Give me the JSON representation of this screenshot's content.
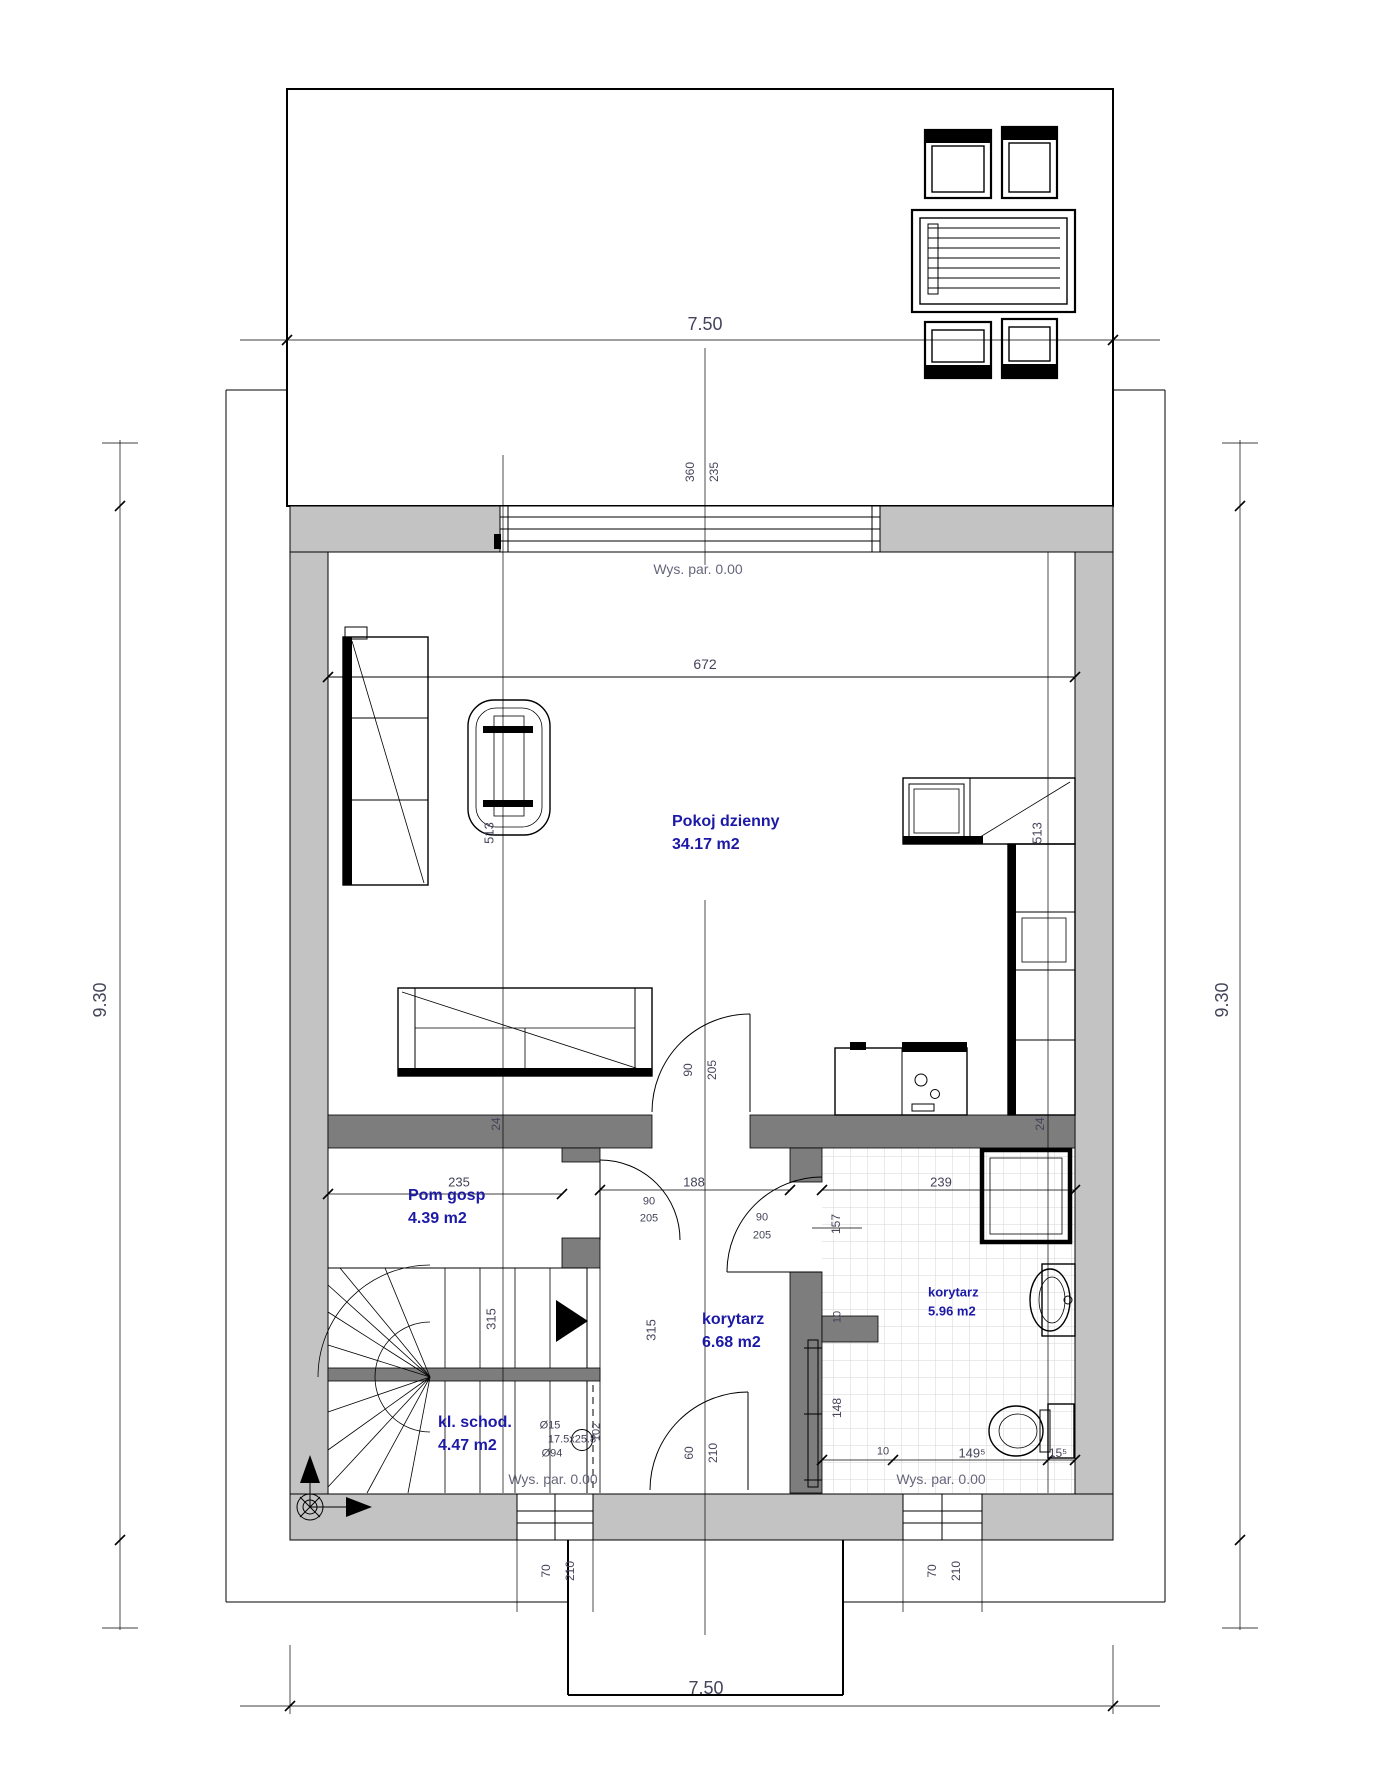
{
  "colors": {
    "outer_wall": "#c3c3c3",
    "partition_wall": "#7d7d7d",
    "room_label": "#1c19a6",
    "dim_text": "#44445a",
    "level_text": "#66667c",
    "line": "#000000",
    "tile_line": "#d6d6d6"
  },
  "rooms": [
    {
      "name": "Pokoj dzienny",
      "area": "34.17 m2",
      "x": 672,
      "y": 822,
      "small": false
    },
    {
      "name": "Pom gosp",
      "area": "4.39 m2",
      "x": 408,
      "y": 1196,
      "small": false
    },
    {
      "name": "korytarz",
      "area": "6.68 m2",
      "x": 702,
      "y": 1320,
      "small": false
    },
    {
      "name": "korytarz",
      "area": "5.96 m2",
      "x": 928,
      "y": 1292,
      "small": true
    },
    {
      "name": "kl. schod.",
      "area": "4.47 m2",
      "x": 438,
      "y": 1423,
      "small": false
    }
  ],
  "levels": [
    {
      "text": "Wys. par. 0.00",
      "x": 698,
      "y": 569
    },
    {
      "text": "Wys. par. 0.00",
      "x": 553,
      "y": 1479
    },
    {
      "text": "Wys. par. 0.00",
      "x": 941,
      "y": 1479
    }
  ],
  "dims": [
    {
      "t": "7.50",
      "x": 705,
      "y": 324,
      "rot": 0,
      "s": 18
    },
    {
      "t": "7.50",
      "x": 706,
      "y": 1688,
      "rot": 0,
      "s": 18
    },
    {
      "t": "9.30",
      "x": 100,
      "y": 1000,
      "rot": 1,
      "s": 18
    },
    {
      "t": "9.30",
      "x": 1222,
      "y": 1000,
      "rot": 1,
      "s": 18
    },
    {
      "t": "360",
      "x": 690,
      "y": 472,
      "rot": 1,
      "s": 12
    },
    {
      "t": "235",
      "x": 714,
      "y": 472,
      "rot": 1,
      "s": 12
    },
    {
      "t": "672",
      "x": 705,
      "y": 664,
      "rot": 0,
      "s": 14
    },
    {
      "t": "513",
      "x": 489,
      "y": 833,
      "rot": 1,
      "s": 13
    },
    {
      "t": "513",
      "x": 1037,
      "y": 833,
      "rot": 1,
      "s": 13
    },
    {
      "t": "24",
      "x": 496,
      "y": 1124,
      "rot": 1,
      "s": 12
    },
    {
      "t": "24",
      "x": 1040,
      "y": 1124,
      "rot": 1,
      "s": 12
    },
    {
      "t": "90",
      "x": 688,
      "y": 1070,
      "rot": 1,
      "s": 12
    },
    {
      "t": "205",
      "x": 712,
      "y": 1070,
      "rot": 1,
      "s": 12
    },
    {
      "t": "235",
      "x": 459,
      "y": 1182,
      "rot": 0,
      "s": 13
    },
    {
      "t": "188",
      "x": 694,
      "y": 1182,
      "rot": 0,
      "s": 13
    },
    {
      "t": "90",
      "x": 649,
      "y": 1202,
      "rot": 0,
      "s": 11
    },
    {
      "t": "205",
      "x": 649,
      "y": 1219,
      "rot": 0,
      "s": 11
    },
    {
      "t": "90",
      "x": 762,
      "y": 1218,
      "rot": 0,
      "s": 11
    },
    {
      "t": "205",
      "x": 762,
      "y": 1236,
      "rot": 0,
      "s": 11
    },
    {
      "t": "157",
      "x": 836,
      "y": 1224,
      "rot": 1,
      "s": 12
    },
    {
      "t": "239",
      "x": 941,
      "y": 1182,
      "rot": 0,
      "s": 13
    },
    {
      "t": "315",
      "x": 491,
      "y": 1319,
      "rot": 1,
      "s": 13
    },
    {
      "t": "315",
      "x": 651,
      "y": 1330,
      "rot": 1,
      "s": 13
    },
    {
      "t": "10",
      "x": 838,
      "y": 1317,
      "rot": 1,
      "s": 11
    },
    {
      "t": "148",
      "x": 837,
      "y": 1408,
      "rot": 1,
      "s": 12
    },
    {
      "t": "102",
      "x": 597,
      "y": 1432,
      "rot": 1,
      "s": 11
    },
    {
      "t": "Ø15",
      "x": 550,
      "y": 1426,
      "rot": 0,
      "s": 11
    },
    {
      "t": "17.5x25.8",
      "x": 572,
      "y": 1440,
      "rot": 0,
      "s": 11
    },
    {
      "t": "Ø94",
      "x": 552,
      "y": 1454,
      "rot": 0,
      "s": 11
    },
    {
      "t": "60",
      "x": 689,
      "y": 1453,
      "rot": 1,
      "s": 12
    },
    {
      "t": "210",
      "x": 713,
      "y": 1453,
      "rot": 1,
      "s": 12
    },
    {
      "t": "10",
      "x": 883,
      "y": 1452,
      "rot": 0,
      "s": 11
    },
    {
      "t": "149⁵",
      "x": 972,
      "y": 1453,
      "rot": 0,
      "s": 13
    },
    {
      "t": "15⁵",
      "x": 1058,
      "y": 1453,
      "rot": 0,
      "s": 12
    },
    {
      "t": "70",
      "x": 546,
      "y": 1571,
      "rot": 1,
      "s": 12
    },
    {
      "t": "210",
      "x": 570,
      "y": 1571,
      "rot": 1,
      "s": 12
    },
    {
      "t": "70",
      "x": 932,
      "y": 1571,
      "rot": 1,
      "s": 12
    },
    {
      "t": "210",
      "x": 956,
      "y": 1571,
      "rot": 1,
      "s": 12
    }
  ]
}
